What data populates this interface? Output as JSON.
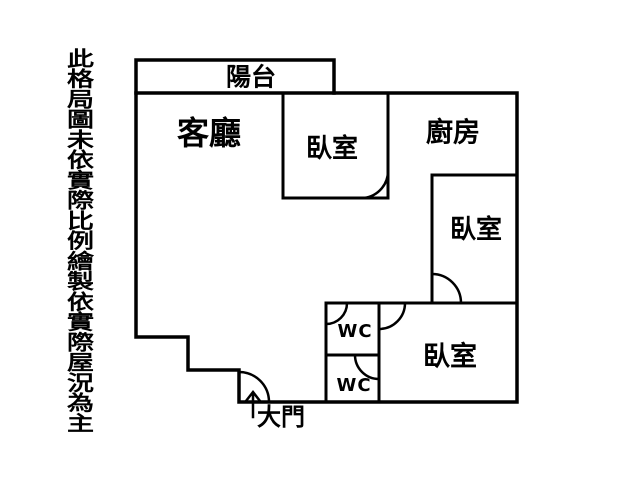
{
  "colors": {
    "line": "#000000",
    "background": "#ffffff"
  },
  "disclaimer": "此格局圖未依實際比例繪製依實際屋況為主",
  "labels": {
    "balcony": "陽台",
    "living_room": "客廳",
    "bedroom_top": "臥室",
    "kitchen": "廚房",
    "bedroom_right": "臥室",
    "bedroom_bottom": "臥室",
    "wc_upper": "WC",
    "wc_lower": "WC",
    "entrance": "大門"
  }
}
